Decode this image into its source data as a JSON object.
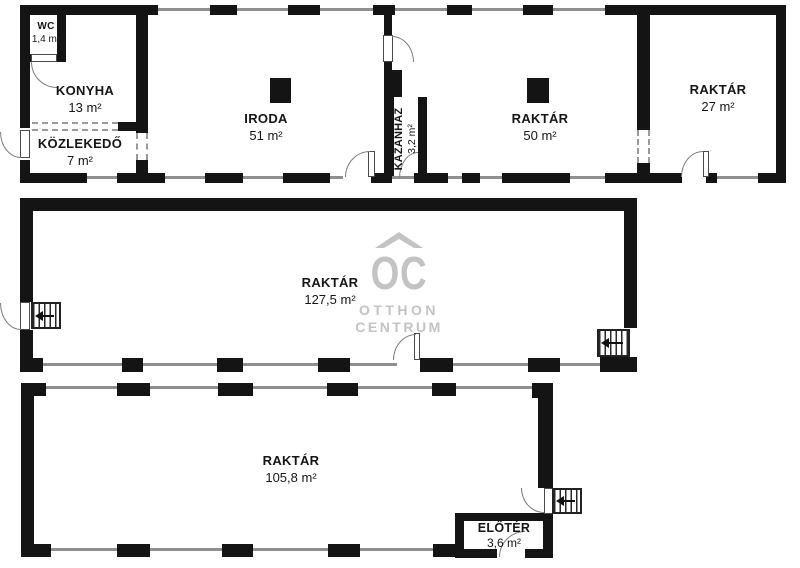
{
  "watermark": {
    "logo": "OC",
    "line1": "OTTHON",
    "line2": "CENTRUM"
  },
  "rooms": {
    "wc": {
      "name": "WC",
      "area": "1,4 m²"
    },
    "konyha": {
      "name": "KONYHA",
      "area": "13 m²"
    },
    "kozlekedo": {
      "name": "KÖZLEKEDŐ",
      "area": "7 m²"
    },
    "iroda": {
      "name": "IRODA",
      "area": "51 m²"
    },
    "kazanhaz": {
      "name": "KAZÁNHÁZ",
      "area": "3,2 m²"
    },
    "raktar_50": {
      "name": "RAKTÁR",
      "area": "50 m²"
    },
    "raktar_27": {
      "name": "RAKTÁR",
      "area": "27 m²"
    },
    "raktar_127": {
      "name": "RAKTÁR",
      "area": "127,5 m²"
    },
    "raktar_105": {
      "name": "RAKTÁR",
      "area": "105,8 m²"
    },
    "eloter": {
      "name": "ELŐTÉR",
      "area": "3,6 m²"
    }
  },
  "colors": {
    "wall": "#141414",
    "window_line": "#8f8f8f",
    "watermark": "#c3c3c3",
    "background": "#ffffff"
  }
}
